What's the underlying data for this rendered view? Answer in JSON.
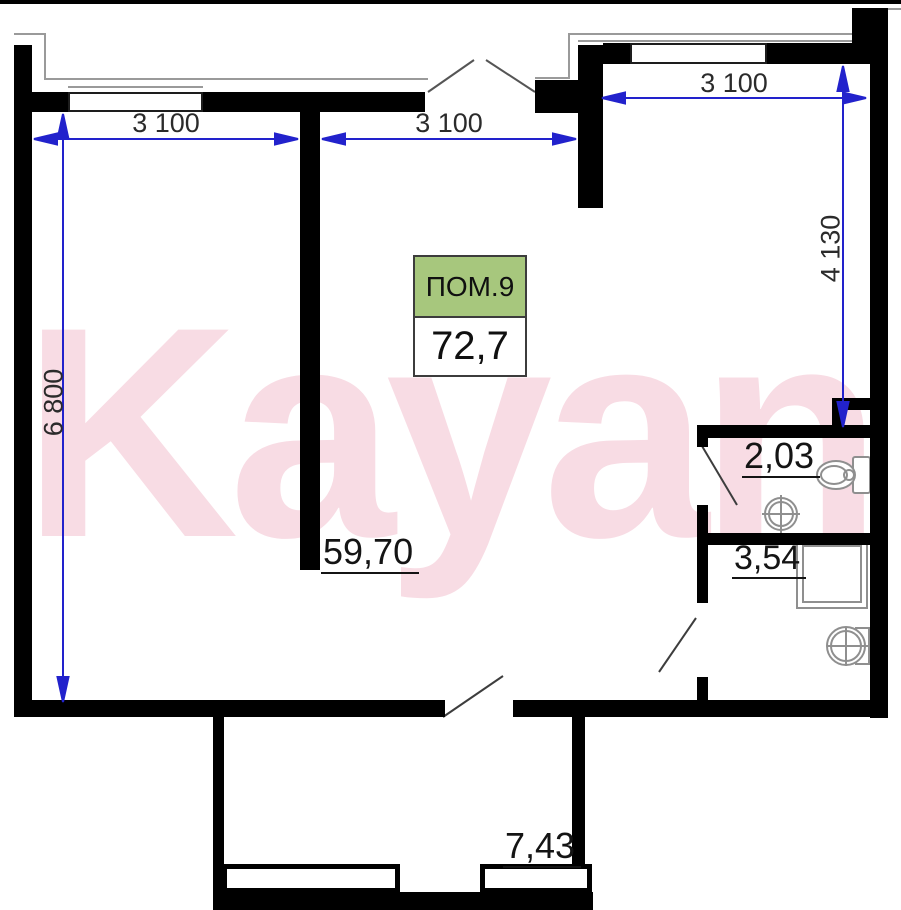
{
  "title_box": {
    "label": "ПОМ.9",
    "area": "72,7"
  },
  "area_labels": {
    "living": "59,70",
    "wc": "2,03",
    "bath": "3,54",
    "balcony": "7,43"
  },
  "dimensions": {
    "top_left": "3 100",
    "top_middle": "3 100",
    "top_right": "3 100",
    "left": "6 800",
    "right": "4 130"
  },
  "watermark": "Kayan",
  "colors": {
    "wall": "#000000",
    "dimension_blue": "#2222cc",
    "label_box_green": "#a7c77d",
    "watermark_pink": "#f8dce4"
  }
}
